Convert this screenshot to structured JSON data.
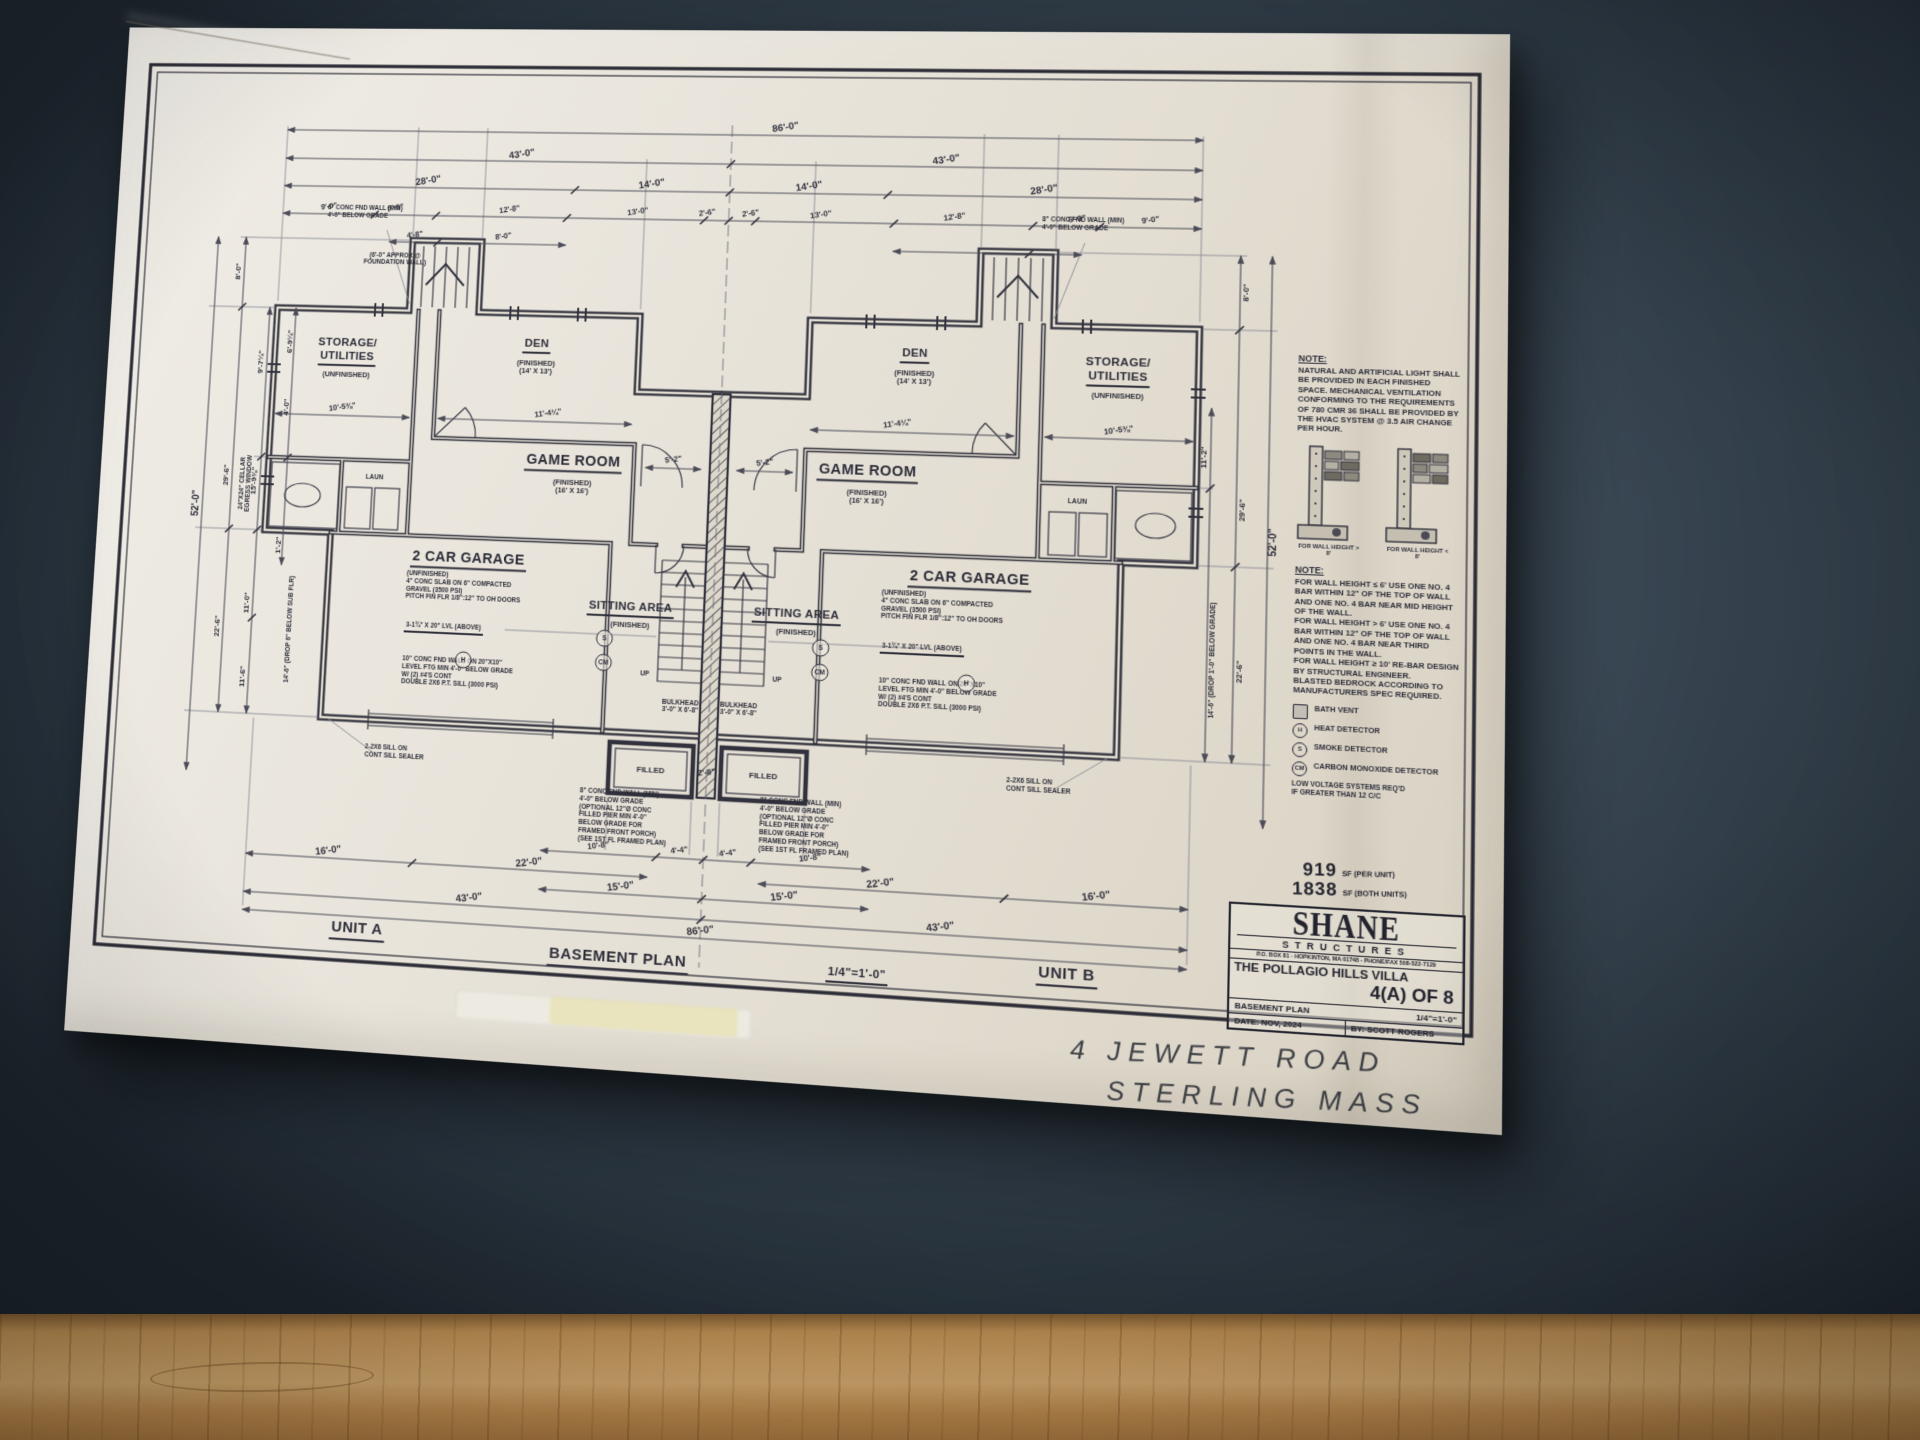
{
  "scene": {
    "desk_color": "#36434f",
    "wood_color": "#c89d63",
    "paper_color": "#e9e5dc",
    "ink_color": "#2e2e3a"
  },
  "handwriting": {
    "line1": "4 JEWETT ROAD",
    "line2": "STERLING MASS"
  },
  "plan": {
    "unit_a": "UNIT A",
    "unit_b": "UNIT B",
    "sheet_title": "BASEMENT PLAN",
    "scale": "1/4\"=1'-0\"",
    "area_value_per_unit": "919",
    "area_label_per_unit": "SF (PER UNIT)",
    "area_value_both": "1838",
    "area_label_both": "SF (BOTH UNITS)"
  },
  "rooms": {
    "storage_line1": "STORAGE/",
    "storage_line2": "UTILITIES",
    "storage_sub": "(UNFINISHED)",
    "den": "DEN",
    "den_sub": "(FINISHED)\n(14' X 13')",
    "game": "GAME ROOM",
    "game_sub": "(FINISHED)\n(16' X 16')",
    "garage": "2 CAR GARAGE",
    "sitting": "SITTING AREA",
    "sitting_sub": "(FINISHED)",
    "filled": "FILLED",
    "laun": "LAUN",
    "up": "UP"
  },
  "annotations": {
    "fnd_note": "8\" CONC FND WALL (MIN)\n4'-0\" BELOW GRADE",
    "sill_note": "2-2X6 SILL ON\nCONT SILL SEALER",
    "beam_note": "3-1¾\" X 20\" LVL (ABOVE)",
    "garage_floor_note": "(UNFINISHED)\n4\" CONC SLAB ON 6\" COMPACTED\nGRAVEL (3500 PSI)\nPITCH FIN FLR 1/8\":12\" TO OH DOORS",
    "garage_wall_note": "10\" CONC FND WALL ON 20\"X10\"\nLEVEL FTG MIN 4'-0\" BELOW GRADE\nW/ (2) #4'S CONT\nDOUBLE 2X6 P.T. SILL (3000 PSI)",
    "porch_note": "8\" CONC FND WALL (MIN)\n4'-0\" BELOW GRADE\n(OPTIONAL 12\"Ø CONC\nFILLED PIER MIN 4'-0\"\nBELOW GRADE FOR\nFRAMED FRONT PORCH)\n(SEE 1ST FL FRAMED PLAN)",
    "egress_note": "24\"X24\" CELLAR\nEGRESS WINDOW",
    "drop_left": "14'-6\" (DROP 6\" BELOW SUB FLR)",
    "drop_right": "14'-6\" (DROP 1'-0\" BELOW GRADE)",
    "fnd_approx": "(6'-0\" APPROX @\nFOUNDATION WALL)",
    "bulkhead": "BULKHEAD\n3'-0\" X 6'-8\""
  },
  "notes": {
    "title": "NOTE:",
    "note1": "NATURAL AND ARTIFICIAL LIGHT SHALL BE PROVIDED IN EACH FINISHED SPACE. MECHANICAL VENTILATION CONFORMING TO THE REQUIREMENTS OF 780 CMR 36 SHALL BE PROVIDED BY THE HVAC SYSTEM @ 3.5 AIR CHANGE PER HOUR.",
    "note2": "FOR WALL HEIGHT ≤ 6' USE ONE NO. 4 BAR WITHIN 12\" OF THE TOP OF WALL AND ONE NO. 4 BAR NEAR MID HEIGHT OF THE WALL.\nFOR WALL HEIGHT > 6' USE ONE NO. 4 BAR WITHIN 12\" OF THE TOP OF WALL AND ONE NO. 4 BAR NEAR THIRD POINTS IN THE WALL.\nFOR WALL HEIGHT ≥ 10' RE-BAR DESIGN BY STRUCTURAL ENGINEER.\nBLASTED BEDROCK ACCORDING TO MANUFACTURERS SPEC REQUIRED.",
    "detail_caption_left": "FOR WALL HEIGHT > 8'",
    "detail_caption_right": "FOR WALL HEIGHT < 8'"
  },
  "legend": {
    "bath_vent": "BATH VENT",
    "heat_symbol": "H",
    "heat": "HEAT DETECTOR",
    "smoke_symbol": "S",
    "smoke": "SMOKE DETECTOR",
    "co_symbol": "CM",
    "co": "CARBON MONOXIDE DETECTOR",
    "low_voltage": "LOW VOLTAGE SYSTEMS REQ'D\nIF GREATER THAN 12 C/C"
  },
  "title_block": {
    "company_top": "SHANE",
    "company_bottom": "STRUCTURES",
    "address": "P.O. BOX 81 - HOPKINTON, MA 01748 - PHONE/FAX 508-522-7129",
    "project": "THE POLLAGIO HILLS VILLA",
    "sheet": "4(A) OF 8",
    "plan_name": "BASEMENT PLAN",
    "scale": "1/4\"=1'-0\"",
    "date_label": "DATE:",
    "date": "NOV, 2024",
    "by_label": "BY:",
    "by": "SCOTT ROGERS"
  },
  "dims": {
    "d86": "86'-0\"",
    "d43": "43'-0\"",
    "d28": "28'-0\"",
    "d14": "14'-0\"",
    "d9_0": "9'-0\"",
    "d6_0": "6'-0\"",
    "d12_8": "12'-8\"",
    "d13_0": "13'-0\"",
    "d2_6": "2'-6\"",
    "d4_8": "4'-8\"",
    "d8_0": "8'-0\"",
    "d52": "52'-0\"",
    "d29_6": "29'-6\"",
    "d22_6": "22'-6\"",
    "d9_7": "9'-7¼\"",
    "d15_9": "15'-9⅜\"",
    "d11_0": "11'-0\"",
    "d11_6": "11'-6\"",
    "d6_9": "6'-9¼\"",
    "d4_0": "4'-0\"",
    "d1_2": "1'-2\"",
    "d11_2": "11'-2\"",
    "d10_5": "10'-5⅜\"",
    "d11_4": "11'-4¼\"",
    "d5_2": "5'-2\"",
    "d2_8": "2'-8\"",
    "d10_8": "10'-8\"",
    "d4_4": "4'-4\"",
    "d16": "16'-0\"",
    "d22": "22'-0\"",
    "d15": "15'-0\""
  }
}
